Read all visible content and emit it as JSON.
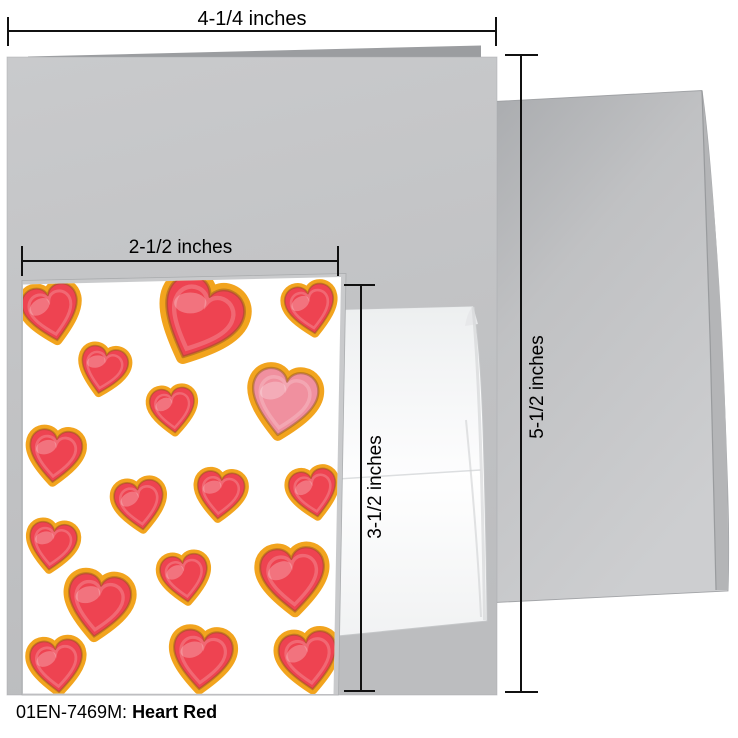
{
  "product": {
    "sku": "01EN-7469M:",
    "name": "Heart Red"
  },
  "dimensions": {
    "card_width": "4-1/4 inches",
    "card_height": "5-1/2 inches",
    "insert_width": "2-1/2 inches",
    "insert_height": "3-1/2 inches"
  },
  "colors": {
    "heart_red": "#ee4351",
    "heart_pink": "#f0909f",
    "cookie_gold": "#f2a41e",
    "cookie_edge_brown": "#8a511b",
    "card_gray": "#c3c4c6",
    "card_back_edge_gray": "#9b9da0",
    "envelope_gray": "#c0c1c3",
    "envelope_white": "#fbfbfc",
    "dimension_line": "#111111",
    "background": "#ffffff"
  }
}
